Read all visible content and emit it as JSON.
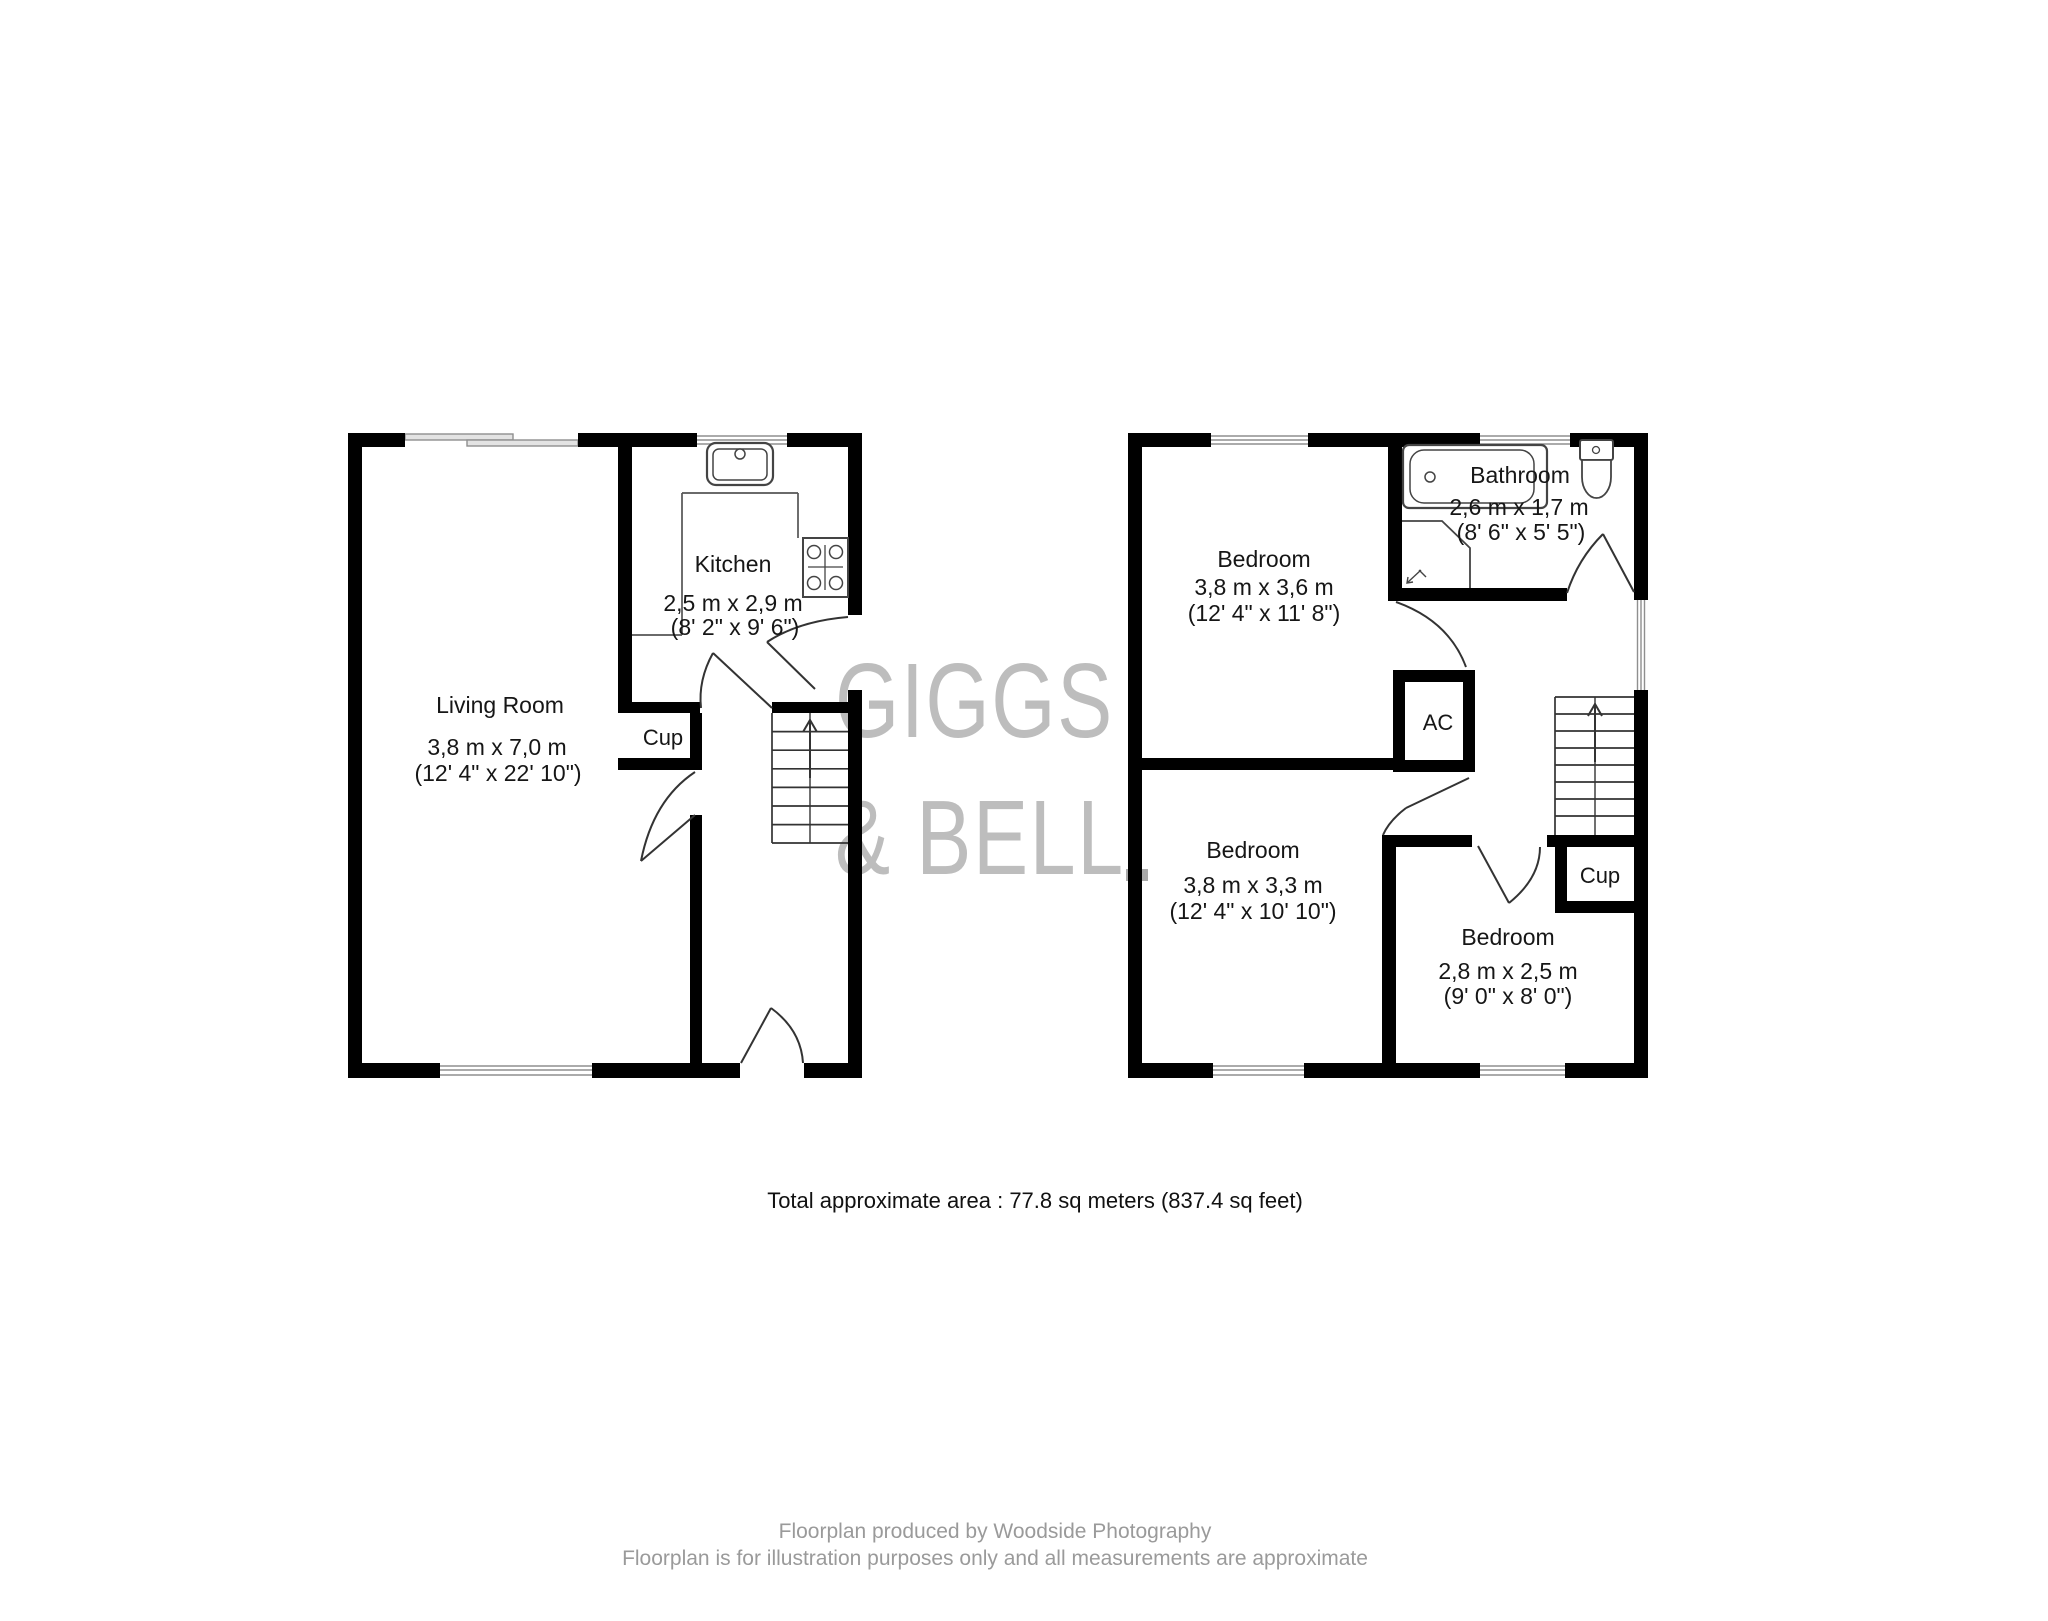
{
  "watermark": {
    "line1": "GIGGS",
    "line2": "& BELL"
  },
  "ground_floor": {
    "living_room": {
      "name": "Living Room",
      "metric": "3,8 m x 7,0 m",
      "imperial": "(12' 4\" x 22' 10\")"
    },
    "kitchen": {
      "name": "Kitchen",
      "metric": "2,5 m x 2,9 m",
      "imperial": "(8' 2\" x 9' 6\")"
    },
    "cupboard": {
      "name": "Cup"
    }
  },
  "first_floor": {
    "bedroom_1": {
      "name": "Bedroom",
      "metric": "3,8 m x 3,6 m",
      "imperial": "(12' 4\" x 11' 8\")"
    },
    "bathroom": {
      "name": "Bathroom",
      "metric": "2,6 m x 1,7 m",
      "imperial": "(8' 6\" x 5' 5\")"
    },
    "bedroom_2": {
      "name": "Bedroom",
      "metric": "3,8 m x 3,3 m",
      "imperial": "(12' 4\" x 10' 10\")"
    },
    "bedroom_3": {
      "name": "Bedroom",
      "metric": "2,8 m x 2,5 m",
      "imperial": "(9' 0\" x 8' 0\")"
    },
    "ac_cupboard": {
      "name": "AC"
    },
    "cupboard": {
      "name": "Cup"
    }
  },
  "summary": {
    "total_area": "Total approximate area : 77.8 sq meters (837.4 sq feet)"
  },
  "footer": {
    "credit": "Floorplan produced by Woodside Photography",
    "disclaimer": "Floorplan is for illustration purposes only and all measurements are approximate"
  },
  "colors": {
    "wall": "#000000",
    "watermark": "#bdbdbd",
    "footer_text": "#9a9a9a",
    "window": "#999999"
  }
}
